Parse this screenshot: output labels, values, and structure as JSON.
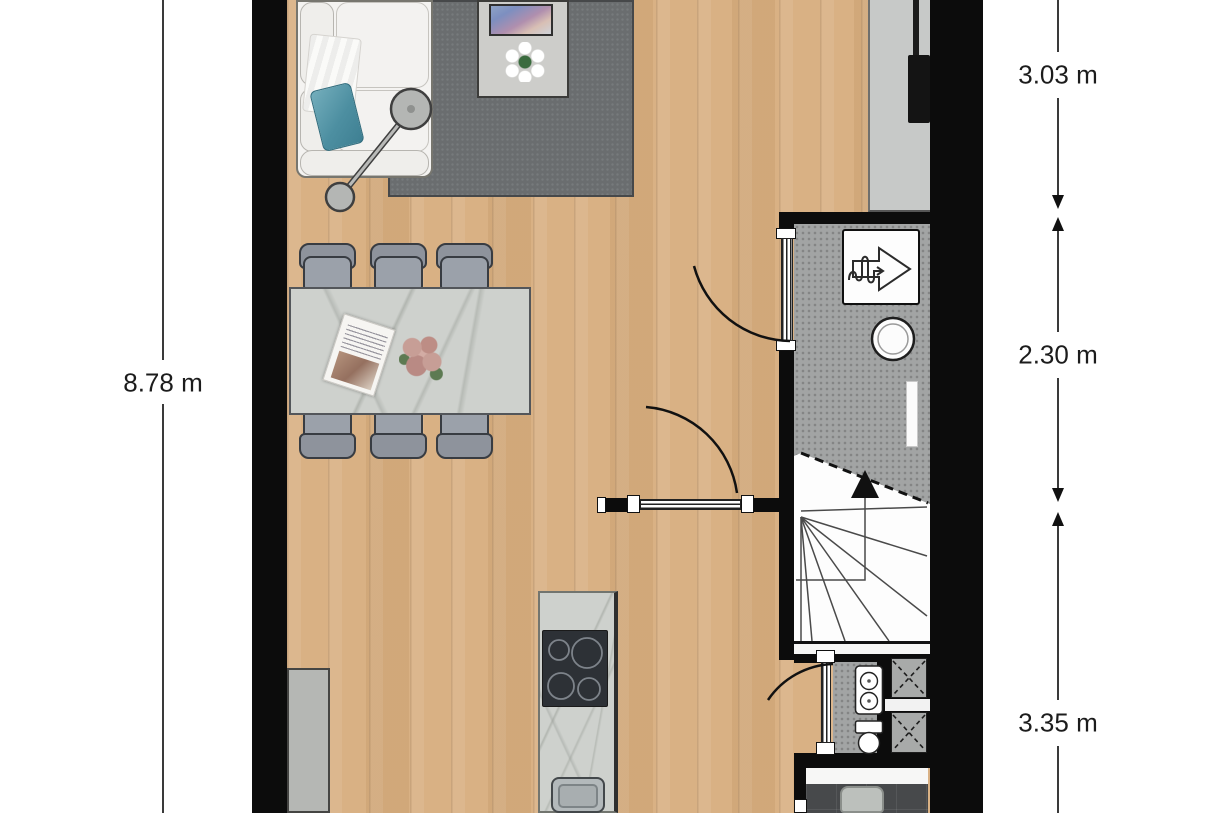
{
  "dimensions": {
    "left": {
      "label": "8.78 m"
    },
    "right": [
      {
        "label": "3.03 m"
      },
      {
        "label": "2.30 m"
      },
      {
        "label": "3.35 m"
      }
    ]
  },
  "icons": {
    "heat_recovery_unit": "heat-recovery-ventilation-unit-icon",
    "boiler": "boiler-icon",
    "stairs_direction": "stairs-up-arrow-icon",
    "duct_shaft": "duct-shaft-x-icon",
    "door_swing": "door-swing-arc-icon"
  },
  "colors": {
    "wall": "#0c0c0c",
    "wood_floor": "#d9b184",
    "rug": "#6a6d6f",
    "hall_floor": "#a2a4a4",
    "marble": "#ced1cd",
    "chair": "#959aa3",
    "bathroom_floor": "#47494b",
    "dimension_text": "#1c1c1c"
  }
}
